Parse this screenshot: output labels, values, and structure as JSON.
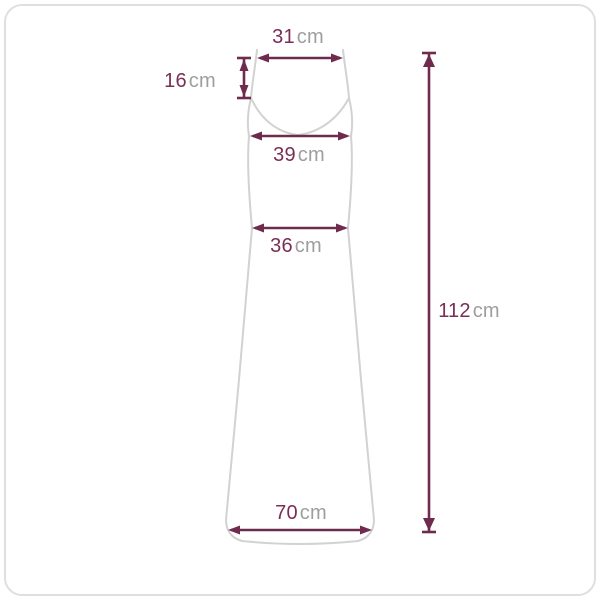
{
  "diagram": {
    "title": "dress-measurement-diagram",
    "unit_default": "cm"
  },
  "measurements": {
    "strap_width": {
      "value": "31",
      "unit": "cm"
    },
    "strap_length": {
      "value": "16",
      "unit": "cm"
    },
    "bust": {
      "value": "39",
      "unit": "cm"
    },
    "waist": {
      "value": "36",
      "unit": "cm"
    },
    "hem": {
      "value": "70",
      "unit": "cm"
    },
    "length": {
      "value": "112",
      "unit": "cm"
    }
  },
  "colors": {
    "dimension_line": "#6e2b4d",
    "value_text": "#7a2e55",
    "unit_text": "#9e9e9e",
    "dress_outline": "#d2d2d2",
    "frame_border": "#dfdfdf",
    "background": "#ffffff"
  }
}
